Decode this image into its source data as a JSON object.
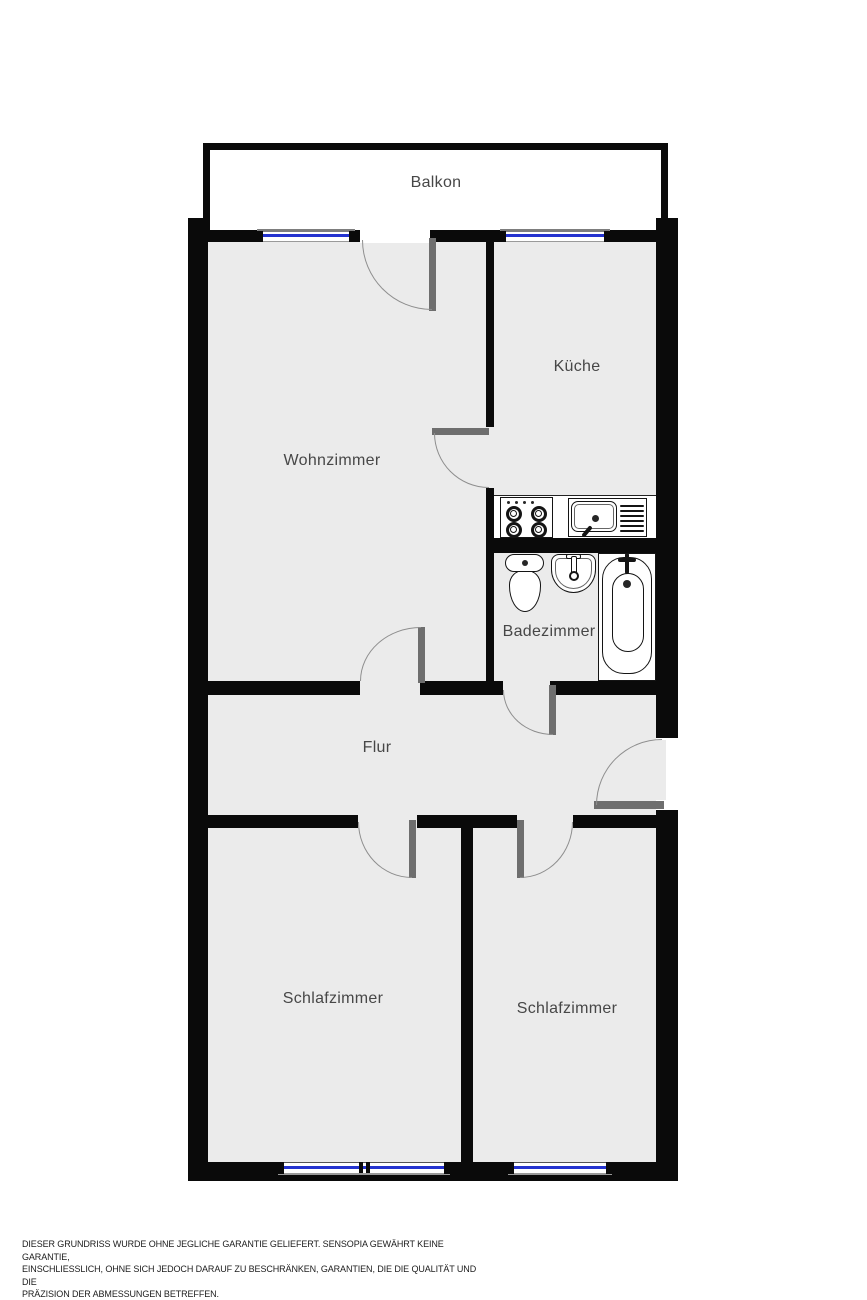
{
  "title": "Grundriss Wohnung",
  "rooms": {
    "balkon": {
      "label": "Balkon"
    },
    "wohnzimmer": {
      "label": "Wohnzimmer"
    },
    "kueche": {
      "label": "Küche"
    },
    "badezimmer": {
      "label": "Badezimmer"
    },
    "flur": {
      "label": "Flur"
    },
    "schlafzimmer_links": {
      "label": "Schlafzimmer"
    },
    "schlafzimmer_rechts": {
      "label": "Schlafzimmer"
    }
  },
  "fixtures": {
    "kueche": [
      "stove",
      "sink-with-drainboard"
    ],
    "badezimmer": [
      "toilet",
      "washbasin",
      "bathtub"
    ]
  },
  "colors": {
    "wall": "#0a0a0a",
    "floor": "#ebebeb",
    "window_glass": "#2433cf",
    "door_leaf": "#6e6e6e",
    "door_arc": "#8e8e8e",
    "background": "#ffffff",
    "label_text": "#474747"
  },
  "disclaimer": {
    "lines": [
      "DIESER GRUNDRISS WURDE OHNE JEGLICHE GARANTIE GELIEFERT. SENSOPIA GEWÄHRT KEINE GARANTIE,",
      "EINSCHLIESSLICH, OHNE SICH JEDOCH DARAUF ZU BESCHRÄNKEN, GARANTIEN, DIE DIE QUALITÄT UND DIE",
      "PRÄZISION DER ABMESSUNGEN BETREFFEN."
    ]
  }
}
